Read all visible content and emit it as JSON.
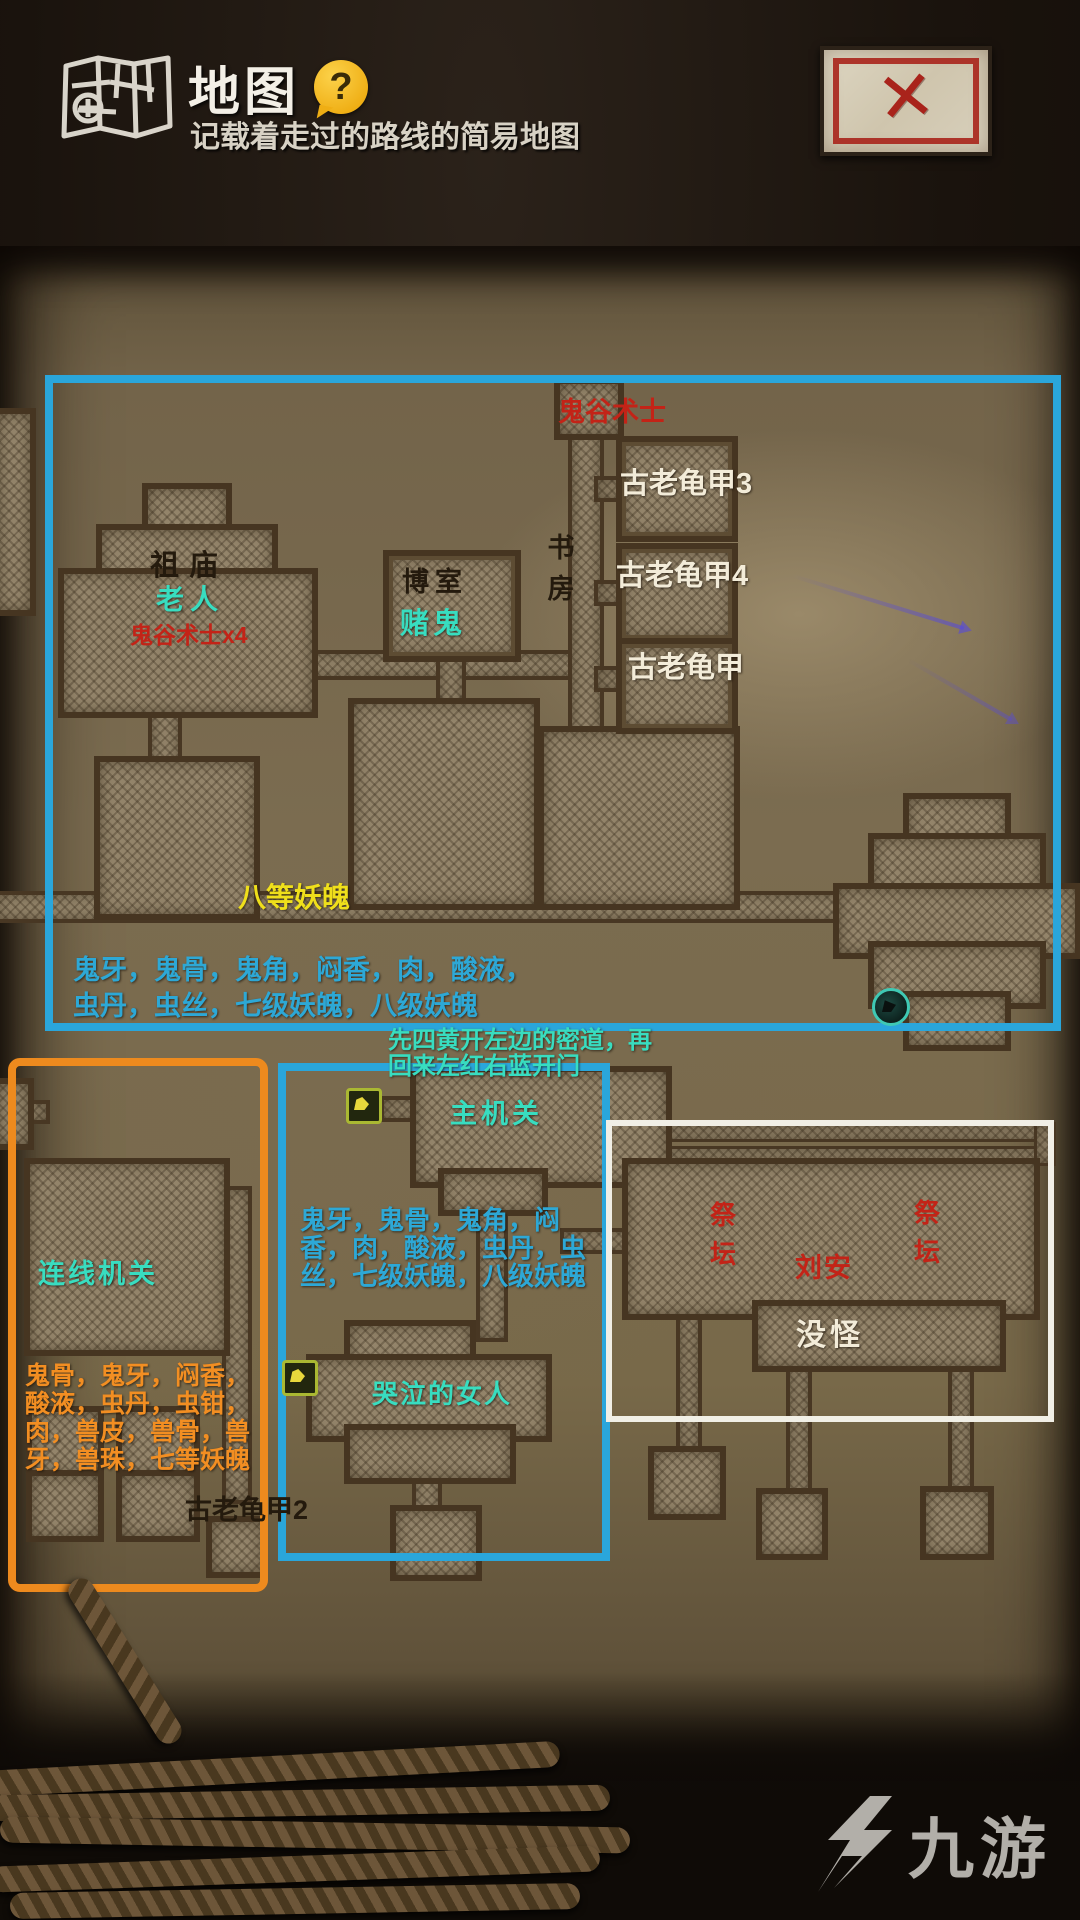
{
  "header": {
    "title": "地图",
    "subtitle": "记载着走过的路线的简易地图",
    "help_glyph": "?"
  },
  "close_button": {
    "glyph": "✕"
  },
  "watermark": {
    "brand": "九游"
  },
  "colors": {
    "route_box_blue": "#2aa6db",
    "route_box_orange": "#ed8a1e",
    "route_box_white": "#f1efe6",
    "label_cyan": "#38ddc0",
    "drops_blue": "#2da8d6",
    "label_yellow": "#efdf1b",
    "label_red": "#c32317",
    "label_orange": "#f28e22",
    "parchment": "#7b6c50"
  },
  "map": {
    "top": {
      "sorcerer": "鬼谷术士",
      "turtle_shell_3": "古老龟甲3",
      "turtle_shell_4": "古老龟甲4",
      "turtle_shell_5": "古老龟甲",
      "study": "书房",
      "temple": "祖庙",
      "old_man": "老人",
      "sorcerer_x4": "鬼谷术士x4",
      "gamble_room": "博室",
      "gambler": "赌鬼",
      "demon_soul_8": "八等妖魄",
      "drops_line1": "鬼牙，鬼骨，鬼角，闷香，肉，酸液，",
      "drops_line2": "虫丹，虫丝，七级妖魄，八级妖魄"
    },
    "hint": {
      "line1": "先四黄开左边的密道，再",
      "line2": "回来左红右蓝开门"
    },
    "middle": {
      "main_mechanism": "主机关",
      "drops_line1": "鬼牙，鬼骨，鬼角，闷",
      "drops_line2": "香，肉，酸液，虫丹，虫",
      "drops_line3": "丝，七级妖魄，八级妖魄",
      "crying_woman": "哭泣的女人"
    },
    "left": {
      "wire_mechanism": "连线机关",
      "drops_line1": "鬼骨，鬼牙，闷香，",
      "drops_line2": "酸液，虫丹，虫钳，",
      "drops_line3": "肉，兽皮，兽骨，兽",
      "drops_line4": "牙，兽珠，七等妖魄",
      "turtle_shell_2": "古老龟甲2"
    },
    "right": {
      "altar_left": "祭坛",
      "altar_right": "祭坛",
      "npc": "刘安",
      "no_monsters": "没怪"
    }
  }
}
